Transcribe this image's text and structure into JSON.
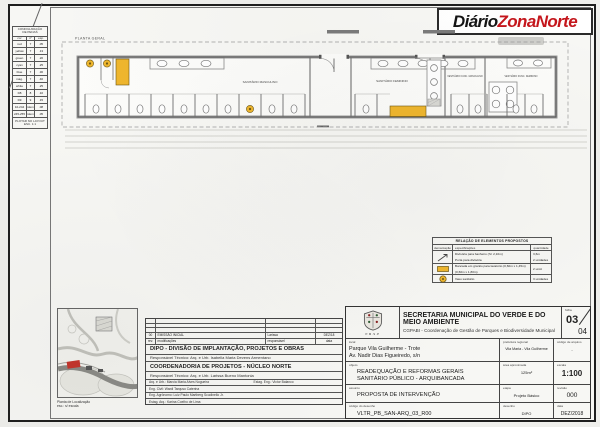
{
  "logo": {
    "black": "Diário",
    "red": "ZonaNorte",
    "red_color": "#c4161c"
  },
  "pen_table": {
    "title_line1": "CONFIGURAÇÃO",
    "title_line2": "DE PENAS",
    "headers": [
      "cor",
      "nº",
      "esp."
    ],
    "rows": [
      [
        "red",
        "7",
        ".05"
      ],
      [
        "yellow",
        "7",
        ".13"
      ],
      [
        "green",
        "7",
        ".20"
      ],
      [
        "cyan",
        "7",
        ".25"
      ],
      [
        "blue",
        "7",
        ".30"
      ],
      [
        "mag.",
        "7",
        ".40"
      ],
      [
        "white",
        "7",
        ".25"
      ],
      [
        "D8",
        "8",
        ".10"
      ],
      [
        "D9",
        "9",
        ".15"
      ],
      [
        "10-244",
        "idem",
        ".08"
      ],
      [
        "245-255",
        "idem",
        ".05"
      ]
    ],
    "footer_line1": "PLOTAR NO LAYOUT",
    "footer_line2": "ESC. 1:1"
  },
  "plan": {
    "title": "PLANTA GERAL",
    "room_masc": "SANITÁRIO MASCULINO",
    "room_fem": "SANITÁRIO FEMININO",
    "room_vest_masc": "VESTIÁRIO FUNC. MASCULINO",
    "room_vest_fem": "VESTIÁRIO FUNC. FEMININO",
    "highlight_color": "#efb62d"
  },
  "legend": {
    "title": "RELAÇÃO DE ELEMENTOS PROPOSTOS",
    "h_sym": "demarcação",
    "h_spec": "especificações",
    "h_qty": "quantidade",
    "r1_spec1": "Divisória para banheiro (h= 2,10m)",
    "r1_spec2": "Porta para divisória",
    "r1_qty1": "3,6m",
    "r1_qty2": "2 unidades",
    "r2_spec1": "Bancada em granito para lavatório (0,60m x 1,45m)",
    "r2_spec2": "(0,60m x 1,80m)",
    "r2_qty": "2 unid.",
    "r3_spec": "Vaso sanitário",
    "r3_qty": "3 unidades"
  },
  "keyplan": {
    "caption_line1": "Planta de Localização",
    "caption_line2": "esc.: s/ escala"
  },
  "revisions": {
    "rev_num": "00",
    "rev_desc": "EMISSÃO INICIAL",
    "rev_resp": "Larissa",
    "rev_data": "DEZ/18",
    "h_rev": "rev.",
    "h_mod": "modificações",
    "h_resp": "responsável",
    "h_data": "data"
  },
  "team": {
    "dipo_title": "DIPO - DIVISÃO DE IMPLANTAÇÃO, PROJETOS E OBRAS",
    "dipo_resp": "Responsável Técnico: Arq. e Urb. Isabella Maria Devens Armentano",
    "coord_title": "COORDENADORIA DE PROJETOS - NÚCLEO NORTE",
    "coord_resp": "Responsável Técnico: Arq. e Urb. Larissa Bueno Mantonia",
    "staff1a": "Arq. e Urb.: Marcia Maria Alves Nogueira",
    "staff1b": "Estag. Eng.: Victor Balanco",
    "staff2": "Eng. Civil: Wardi Tarquso Caterina",
    "staff3": "Eng. Agrônomo: Luiz Paulo Martberg Scudinello Jr.",
    "staff4": "Estag. Arq.: Karina Coelho de Lima"
  },
  "title_block": {
    "org_line1": "SECRETARIA MUNICIPAL DO VERDE E DO MEIO AMBIENTE",
    "org_line2": "CGPABI - Coordenação de Gestão de Parques e Biodiversidade Municipal",
    "crest_caption": "P.M.S.P",
    "folha_label": "folha",
    "folha_num": "03",
    "folha_total": "04",
    "local_label": "local",
    "local_line1": "Parque Vila Guilherme - Trote",
    "local_line2": "Av. Nadir Dias Figueiredo, s/n",
    "pref_label": "prefeitura regional",
    "pref_value": "Vila Maria - Vila Guilherme",
    "cod_arq_label": "código de arquivo",
    "cod_arq_value": "-",
    "objeto_label": "objeto",
    "objeto_line1": "READEQUAÇÃO E REFORMAS GERAIS",
    "objeto_line2": "SANITÁRIO PÚBLICO - ARQUIBANCADA",
    "area_label": "área aproximada",
    "area_value": "125m²",
    "escala_label": "escala",
    "escala_value": "1:100",
    "assunto_label": "assunto",
    "assunto_value": "PROPOSTA DE INTERVENÇÃO",
    "etapa_label": "etapa",
    "etapa_value": "Projeto Básico",
    "revisao_label": "revisão",
    "revisao_value": "000",
    "cod_des_label": "código do desenho",
    "cod_des_value": "VLTR_PB_SAN-ARQ_03_R00",
    "desenho_label": "desenho",
    "desenho_value": "DIPO",
    "data_label": "data",
    "data_value": "DEZ/2018"
  }
}
